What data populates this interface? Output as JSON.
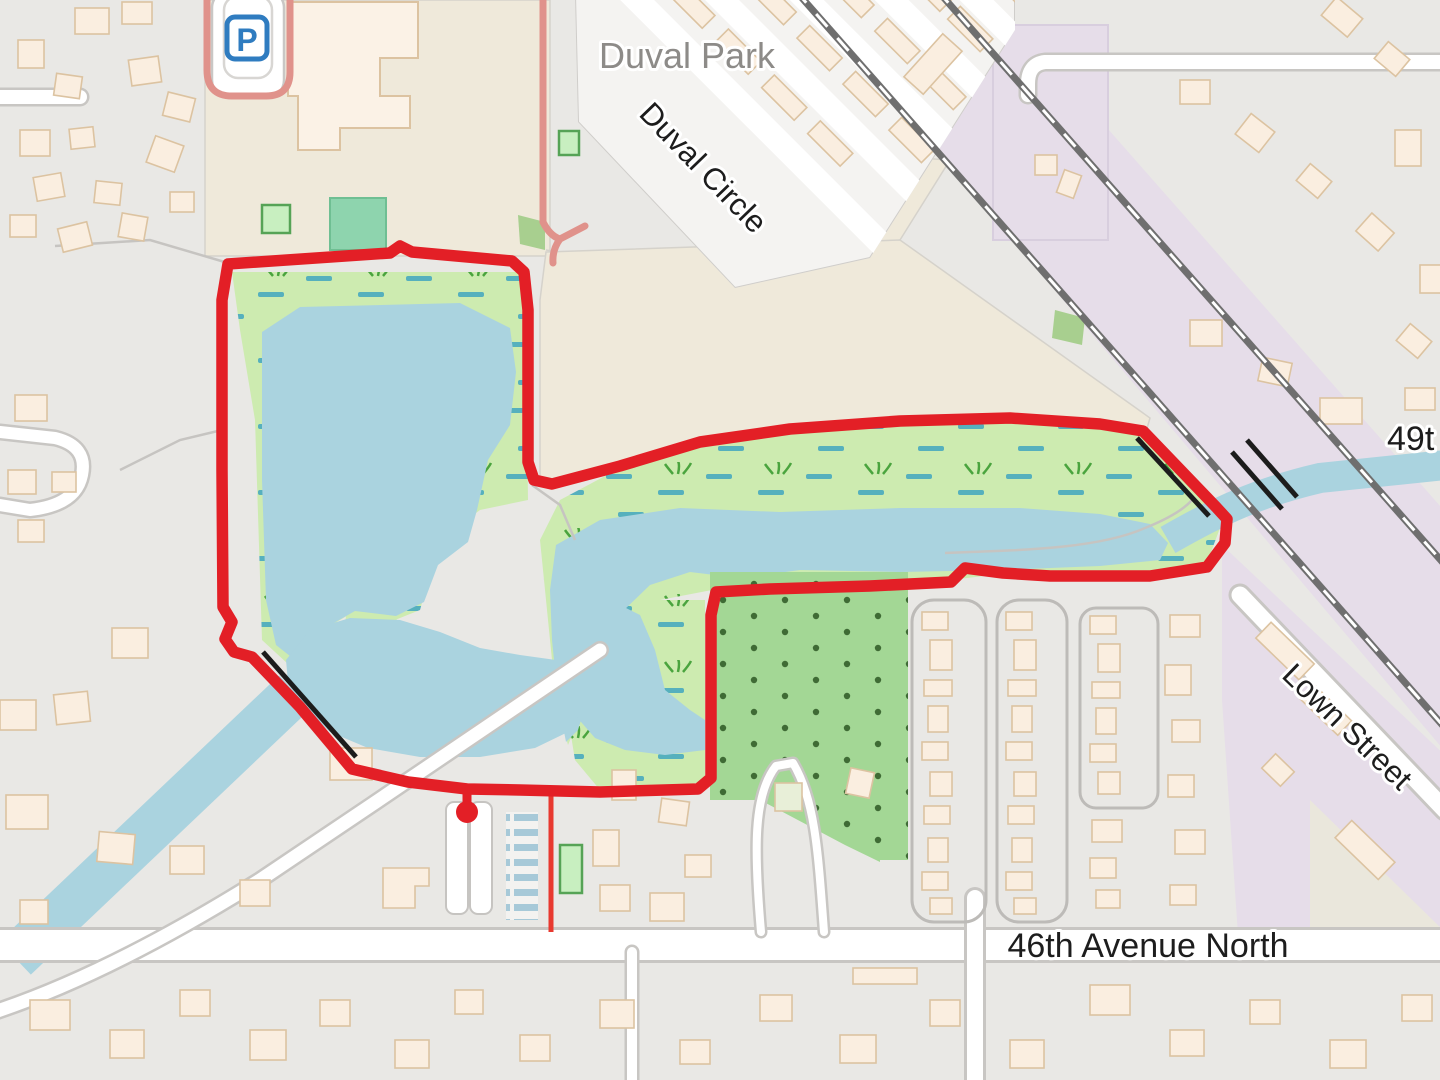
{
  "map": {
    "labels": {
      "park_name": "Duval Park",
      "street_duval_circle": "Duval Circle",
      "street_49th_partial": "49t",
      "street_lown": "Lown Street",
      "street_46th": "46th Avenue North"
    },
    "icons": {
      "parking_symbol": "P"
    },
    "colors": {
      "base": "#e9e8e5",
      "beige": "#efe9da",
      "lavender": "#e6dde9",
      "water": "#aad3df",
      "wetland": "#cdebb0",
      "wetland_dash": "#56b0bd",
      "grass_tuft": "#4aa43e",
      "orchard": "#a3d795",
      "orchard_dot": "#3f6b35",
      "pitch": "#8ed4ae",
      "pitch_light": "#c8efc0",
      "pitch_stroke": "#56a356",
      "building": "#faeee0",
      "building_stroke": "#dcc3a1",
      "road_casing": "#c8c6c3",
      "rail": "#6f6f6f",
      "route": "#e31f26",
      "salmon": "#e0928b",
      "bridge_black": "#1c1c1c",
      "parking_blue": "#2f7cc0",
      "text_dark": "#1d1d1d",
      "text_gray": "#8d8b88",
      "pool_stripe": "#a7c9d8"
    },
    "route": {
      "points_str": "228,264 390,253 400,246 412,252 512,261 524,272 528,310 528,462 534,480 552,484 620,466 700,442 790,429 900,421 1010,418 1100,424 1143,431 1216,507 1227,519 1225,543 1207,567 1150,576 1050,576 1003,573 965,568 951,582 870,586 770,589 716,592 711,615 711,778 698,789 600,792 520,790 467,789 408,782 352,769 300,707 252,657 234,652 225,639 232,622 223,607 222,470 222,300 228,264",
      "start_marker": {
        "x": 467,
        "y": 812
      }
    }
  }
}
